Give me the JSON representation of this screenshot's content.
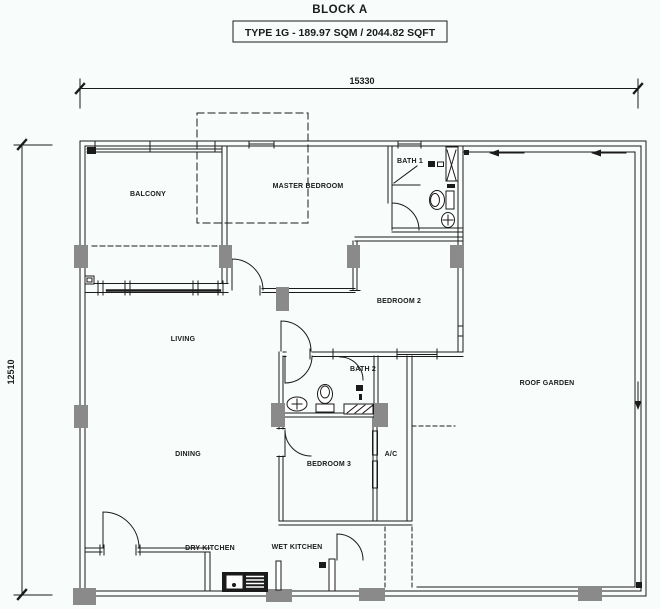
{
  "header": {
    "block_title": "BLOCK A",
    "type_label": "TYPE 1G - 189.97 SQM / 2044.82 SQFT"
  },
  "dimensions": {
    "top": "15330",
    "left": "12510"
  },
  "rooms": [
    {
      "id": "balcony",
      "label": "BALCONY",
      "x": 148,
      "y": 196
    },
    {
      "id": "master-bedroom",
      "label": "MASTER BEDROOM",
      "x": 308,
      "y": 188
    },
    {
      "id": "bath-1",
      "label": "BATH 1",
      "x": 410,
      "y": 163
    },
    {
      "id": "bedroom-2",
      "label": "BEDROOM 2",
      "x": 399,
      "y": 303
    },
    {
      "id": "living",
      "label": "LIVING",
      "x": 183,
      "y": 341
    },
    {
      "id": "bath-2",
      "label": "BATH 2",
      "x": 363,
      "y": 371
    },
    {
      "id": "roof-garden",
      "label": "ROOF GARDEN",
      "x": 547,
      "y": 385
    },
    {
      "id": "dining",
      "label": "DINING",
      "x": 188,
      "y": 456
    },
    {
      "id": "bedroom-3",
      "label": "BEDROOM 3",
      "x": 329,
      "y": 466
    },
    {
      "id": "ac-ledge",
      "label": "A/C",
      "x": 391,
      "y": 456
    },
    {
      "id": "dry-kitchen",
      "label": "DRY KITCHEN",
      "x": 210,
      "y": 550
    },
    {
      "id": "wet-kitchen",
      "label": "WET KITCHEN",
      "x": 297,
      "y": 549
    }
  ],
  "colors": {
    "line": "#1b1b1b",
    "column": "#8a8a8a",
    "background": "#f8fcfb"
  }
}
